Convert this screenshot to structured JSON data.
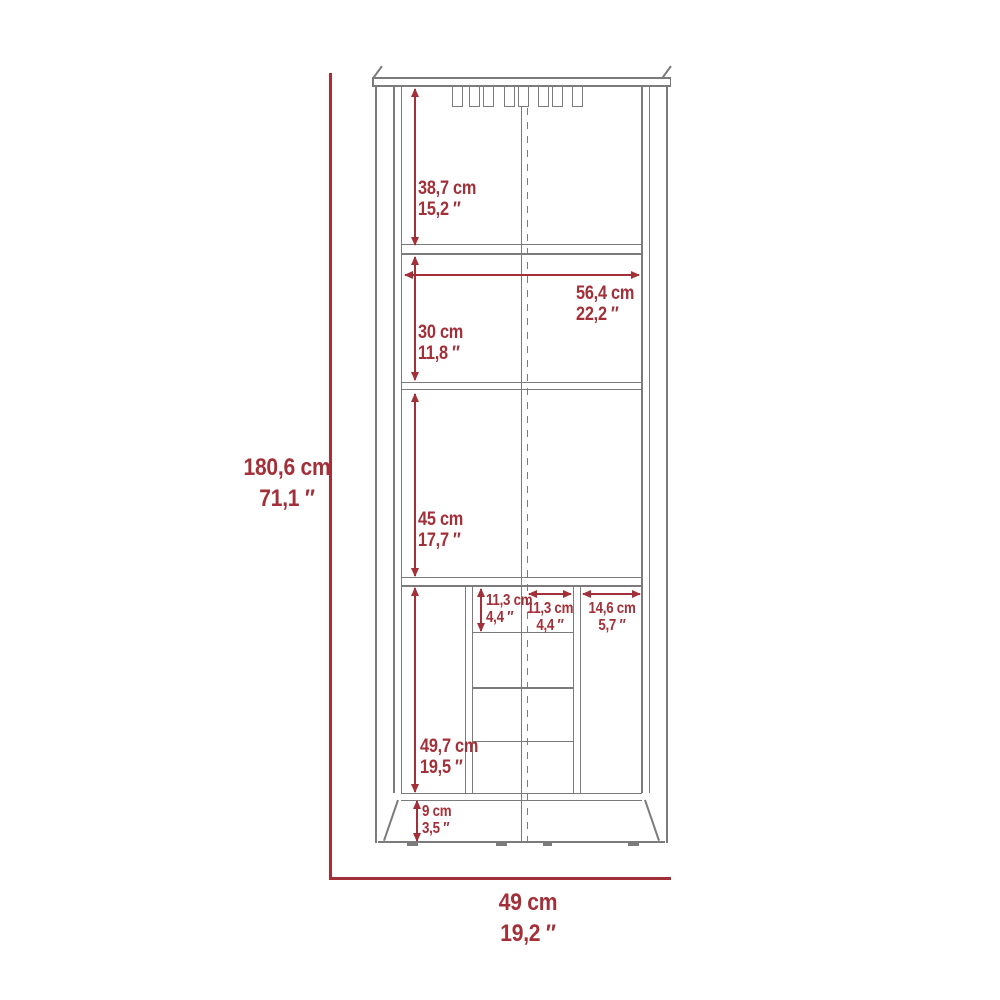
{
  "diagram": {
    "kind": "furniture dimension drawing",
    "subject": "tall corner bar cabinet front elevation",
    "accent_color": "#A23038",
    "line_color": "#7B7B7B",
    "background_color": "#FFFFFF"
  },
  "dimensions": {
    "overall_height": {
      "cm": "180,6 cm",
      "in": "71,1 ″"
    },
    "overall_width": {
      "cm": "49 cm",
      "in": "19,2 ″"
    },
    "top_section_height": {
      "cm": "38,7 cm",
      "in": "15,2 ″"
    },
    "interior_width": {
      "cm": "56,4 cm",
      "in": "22,2 ″"
    },
    "middle_section_height": {
      "cm": "30 cm",
      "in": "11,8 ″"
    },
    "cabinet_section_height": {
      "cm": "45 cm",
      "in": "17,7 ″"
    },
    "cubby_height": {
      "cm": "11,3 cm",
      "in": "4,4 ″"
    },
    "cubby_width": {
      "cm": "11,3 cm",
      "in": "4,4 ″"
    },
    "side_compartment_width": {
      "cm": "14,6 cm",
      "in": "5,7 ″"
    },
    "lower_section_height": {
      "cm": "49,7 cm",
      "in": "19,5 ″"
    },
    "base_height": {
      "cm": "9 cm",
      "in": "3,5 ″"
    }
  }
}
